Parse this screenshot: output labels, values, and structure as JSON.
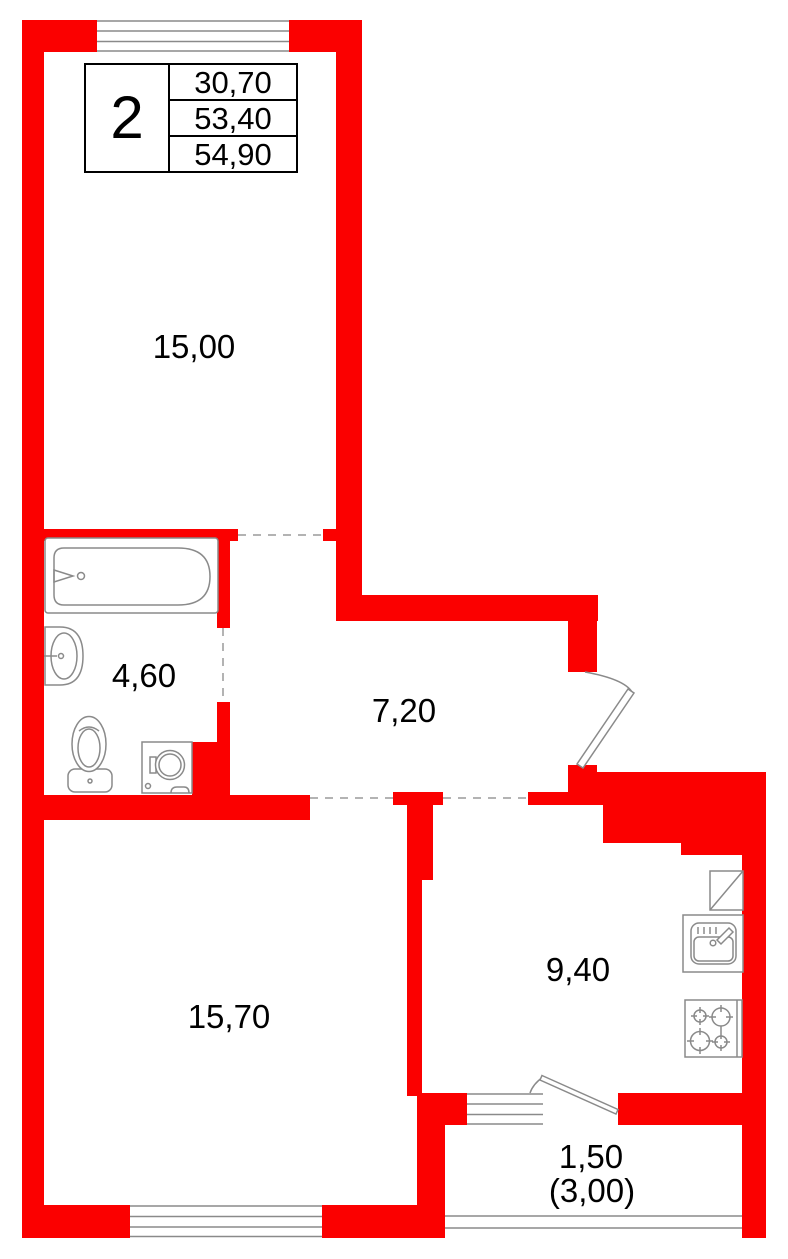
{
  "info_box": {
    "apartment_number": "2",
    "rows": [
      "30,70",
      "53,40",
      "54,90"
    ]
  },
  "labels": {
    "room1": "15,00",
    "bathroom": "4,60",
    "hallway": "7,20",
    "room2": "15,70",
    "kitchen": "9,40",
    "balcony_area": "1,50",
    "balcony_area_total": "(3,00)"
  },
  "colors": {
    "wall_red": "#fb0000",
    "fixture_gray": "#8a8a8a",
    "dash_gray": "#9a9a9a",
    "text_black": "#000000",
    "background": "#ffffff"
  }
}
